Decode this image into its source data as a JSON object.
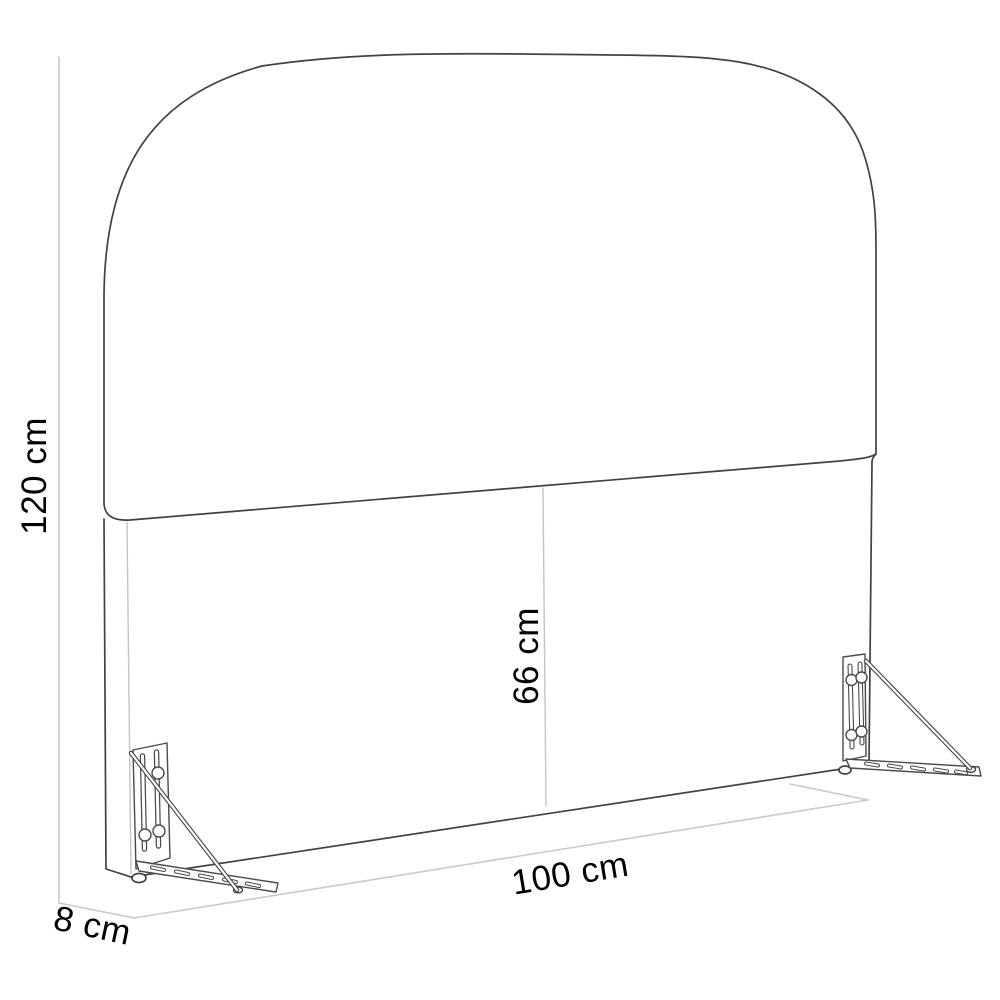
{
  "diagram": {
    "labels": {
      "height": "120 cm",
      "width": "100 cm",
      "depth": "8 cm",
      "panel_height": "66 cm"
    },
    "colors": {
      "background": "#ffffff",
      "outline": "#424242",
      "inner_edge": "#c4c4c4",
      "dimension_line": "#c9c9c9",
      "label_text": "#000000"
    }
  }
}
